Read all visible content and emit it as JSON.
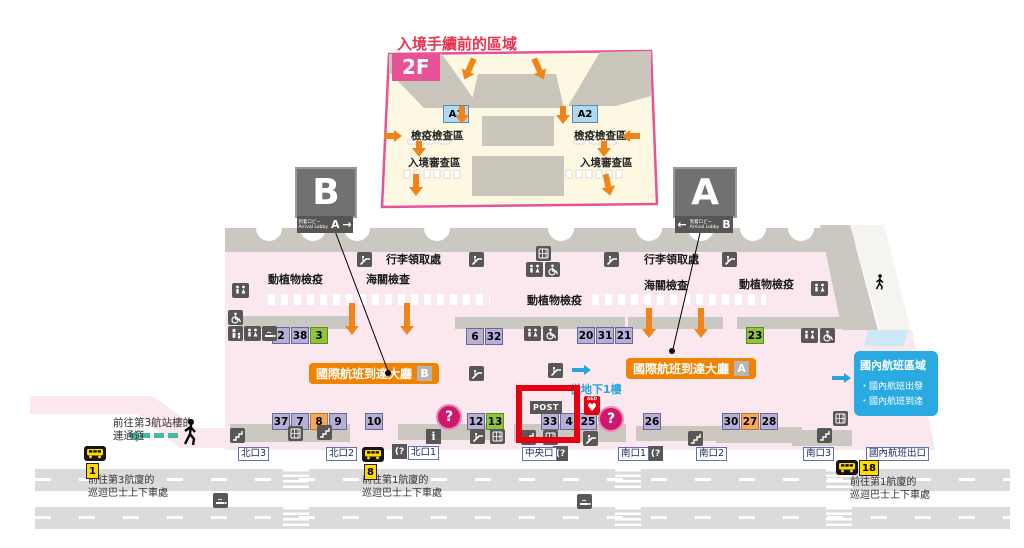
{
  "colors": {
    "highlight_red": "#e60012",
    "banner_orange": "#f08300",
    "domestic_blue": "#29abe2",
    "arrow_orange": "#f08419",
    "inset_border": "#e85298",
    "title_red": "#e8334c"
  },
  "inset": {
    "title": "入境手續前的區域",
    "floor": "2F",
    "gate_a1": "A1",
    "gate_a2": "A2",
    "quarantine_l": "檢疫檢查區",
    "quarantine_r": "檢疫檢查區",
    "immigration_l": "入境審查區",
    "immigration_r": "入境審查區"
  },
  "signs": {
    "b": {
      "letter": "B",
      "lobby_jp": "到着ロビー",
      "lobby_en": "Arrival Lobby",
      "target": "A",
      "arrow": "→"
    },
    "a": {
      "letter": "A",
      "lobby_jp": "到着ロビー",
      "lobby_en": "Arrival Lobby",
      "target": "B",
      "arrow": "←"
    }
  },
  "hall": {
    "baggage_l": "行李領取處",
    "baggage_r": "行李領取處",
    "plant_quarantine_l": "動植物檢疫",
    "customs_l": "海關檢查",
    "plant_quarantine_m": "動植物檢疫",
    "customs_r": "海關檢查",
    "plant_quarantine_r": "動植物檢疫",
    "arrival_banner_b": {
      "label": "國際航班到達大廳",
      "letter": "B"
    },
    "arrival_banner_a": {
      "label": "國際航班到達大廳",
      "letter": "A"
    },
    "from_b1": "從地下1樓",
    "post": "POST",
    "aed": "AED"
  },
  "icons_text": {
    "question": "?",
    "info": "i",
    "phone": "(?"
  },
  "domestic": {
    "title": "國內航班區域",
    "line1": "・國內航班出發",
    "line2": "・國內航班到達"
  },
  "stands": {
    "r1g1": [
      {
        "n": "2"
      },
      {
        "n": "38"
      },
      {
        "n": "3",
        "c": "green"
      }
    ],
    "r1g2": [
      {
        "n": "6"
      },
      {
        "n": "32"
      }
    ],
    "r1g3": [
      {
        "n": "20"
      },
      {
        "n": "31"
      },
      {
        "n": "21"
      }
    ],
    "r1g4": [
      {
        "n": "23",
        "c": "green"
      }
    ],
    "r2g1": [
      {
        "n": "37"
      },
      {
        "n": "7"
      },
      {
        "n": "8",
        "c": "orange"
      },
      {
        "n": "9"
      }
    ],
    "r2g2": [
      {
        "n": "10"
      }
    ],
    "r2g3": [
      {
        "n": "12"
      },
      {
        "n": "13",
        "c": "green"
      }
    ],
    "r2g4": [
      {
        "n": "33"
      },
      {
        "n": "4"
      },
      {
        "n": "25"
      }
    ],
    "r2g5": [
      {
        "n": "26"
      }
    ],
    "r2g6": [
      {
        "n": "30"
      },
      {
        "n": "27",
        "c": "orange"
      },
      {
        "n": "28"
      }
    ]
  },
  "exits": {
    "north3": "北口3",
    "north2": "北口2",
    "north1": "北口1",
    "central": "中央口",
    "south1": "南口1",
    "south2": "南口2",
    "south3": "南口3",
    "domestic": "國內航班出口"
  },
  "bus": {
    "stop1": "1",
    "stop8": "8",
    "stop18": "18"
  },
  "notes": {
    "walkway_l1": "前往第3航站樓的",
    "walkway_l2": "連通道",
    "bus1_l1": "前往第3航廈的",
    "bus1_l2": "巡迴巴士上下車處",
    "bus8_l1": "前往第1航廈的",
    "bus8_l2": "巡迴巴士上下車處",
    "bus18_l1": "前往第1航廈的",
    "bus18_l2": "巡迴巴士上下車處"
  }
}
